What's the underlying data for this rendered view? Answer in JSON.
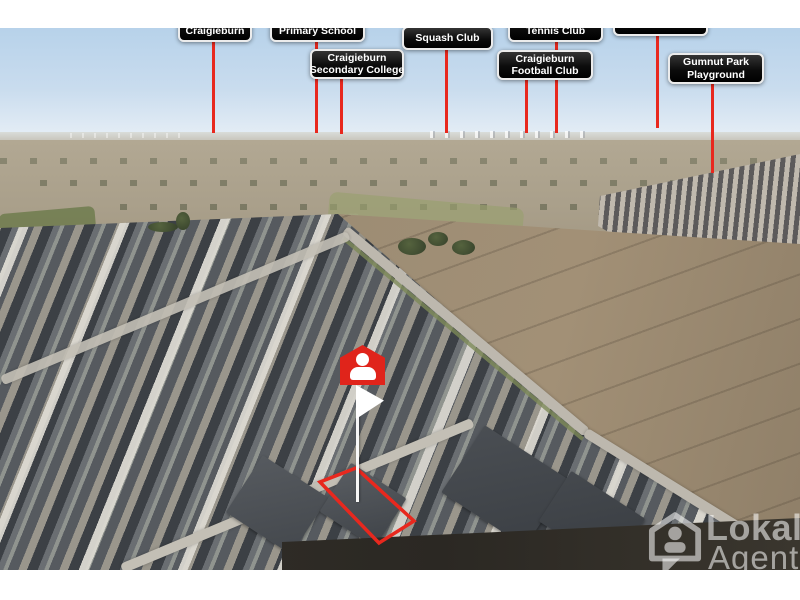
{
  "photo": {
    "description": "Aerial drone photograph of a suburban housing estate beside brown farmland, annotated with nearby amenities",
    "scene_colors": {
      "sky_top": "#b7d2ea",
      "sky_horizon": "#e6eef6",
      "plains": "#aca188",
      "field_brown": "#93836c",
      "suburb_roofs": "#4a4e53",
      "roads": "#c0bcb2",
      "dark_ground": "#2f2b26",
      "grass": "#7d8a57"
    }
  },
  "accent": {
    "callout_red": "#e8281e",
    "marker_red": "#e0241b",
    "label_bg": "#0c0c0c",
    "label_border": "#ececec",
    "label_text": "#ffffff"
  },
  "labels": [
    {
      "id": "craigieburn",
      "lines": [
        "Craigieburn"
      ],
      "clipped": true,
      "box": {
        "left": 178,
        "top": -16,
        "width": 74,
        "height": 30
      },
      "line": {
        "x": 212,
        "top": 12,
        "height": 93
      }
    },
    {
      "id": "primary-school",
      "lines": [
        "Primary School"
      ],
      "clipped": true,
      "box": {
        "left": 270,
        "top": -16,
        "width": 95,
        "height": 30
      },
      "line": {
        "x": 315,
        "top": 12,
        "height": 93
      }
    },
    {
      "id": "secondary-college",
      "lines": [
        "Craigieburn",
        "Secondary College"
      ],
      "clipped": false,
      "box": {
        "left": 310,
        "top": 21,
        "width": 94,
        "height": 30
      },
      "line": {
        "x": 340,
        "top": 49,
        "height": 57
      }
    },
    {
      "id": "squash-club",
      "lines": [
        "Squash Club"
      ],
      "clipped": false,
      "box": {
        "left": 402,
        "top": -2,
        "width": 91,
        "height": 24
      },
      "line": {
        "x": 445,
        "top": 20,
        "height": 85
      }
    },
    {
      "id": "tennis-club",
      "lines": [
        "Tennis Club"
      ],
      "clipped": true,
      "box": {
        "left": 508,
        "top": -16,
        "width": 95,
        "height": 30
      },
      "line": {
        "x": 555,
        "top": 12,
        "height": 93
      }
    },
    {
      "id": "football-club",
      "lines": [
        "Craigieburn",
        "Football Club"
      ],
      "clipped": false,
      "box": {
        "left": 497,
        "top": 22,
        "width": 96,
        "height": 30
      },
      "line": {
        "x": 525,
        "top": 51,
        "height": 54
      }
    },
    {
      "id": "unlabeled",
      "lines": [],
      "clipped": true,
      "box": {
        "left": 613,
        "top": -22,
        "width": 95,
        "height": 30
      },
      "line": {
        "x": 656,
        "top": 8,
        "height": 92
      }
    },
    {
      "id": "gumnut-park",
      "lines": [
        "Gumnut Park",
        "Playground"
      ],
      "clipped": false,
      "box": {
        "left": 668,
        "top": 25,
        "width": 96,
        "height": 31
      },
      "line": {
        "x": 711,
        "top": 55,
        "height": 90
      }
    }
  ],
  "marker": {
    "pin": {
      "left": 340,
      "top": 317,
      "width": 45,
      "height": 40
    },
    "flag": {
      "left": 356,
      "top": 357,
      "width": 28,
      "height": 34
    },
    "pole": {
      "x": 356,
      "top": 372,
      "height": 102
    }
  },
  "property_outline": {
    "points": "320,454 356,440 414,493 379,515",
    "color": "#e8281e",
    "stroke_width": 3.5
  },
  "watermark": {
    "line1": "Lokal",
    "line2": "Agent"
  }
}
